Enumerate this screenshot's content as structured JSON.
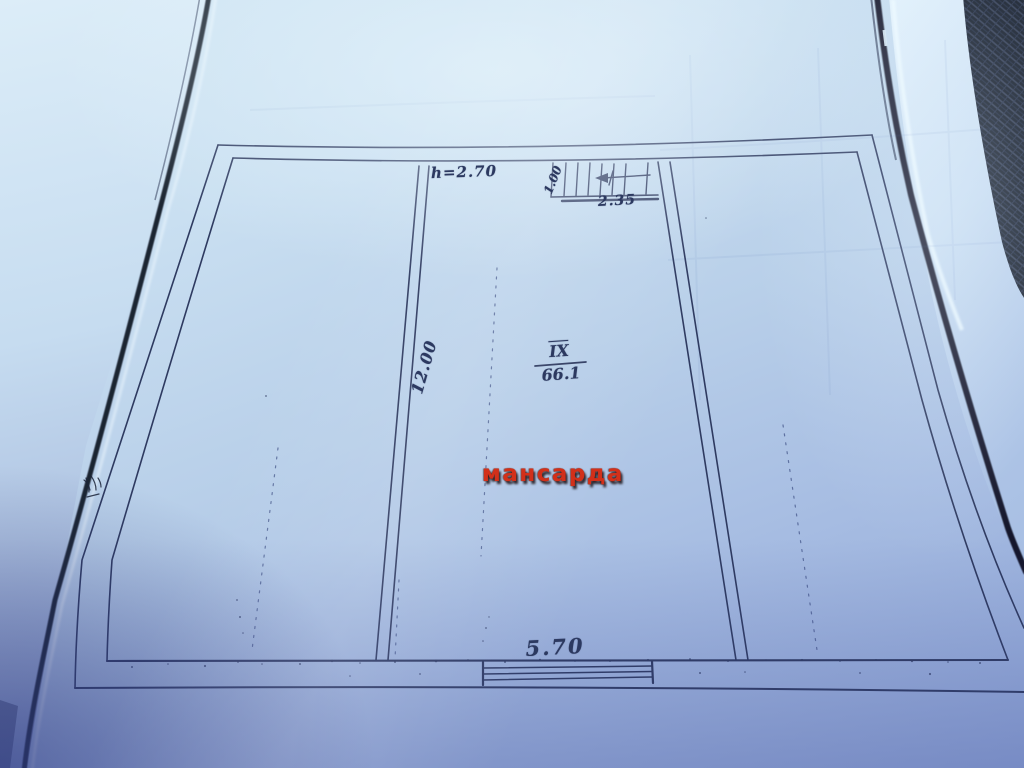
{
  "plan": {
    "stamp": "мансарда",
    "room": {
      "number": "IX",
      "area": "66.1"
    },
    "dimensions": {
      "ceiling_height": "h=2.70",
      "stair_width": "1.00",
      "stair_run": "2.35",
      "room_depth": "12.00",
      "room_width": "5.70"
    },
    "colors": {
      "ink": "#2e3a60",
      "stamp_red": "#d2301a",
      "paper_blue": "#c6dcf0",
      "fabric_dark": "#1a2230"
    }
  }
}
